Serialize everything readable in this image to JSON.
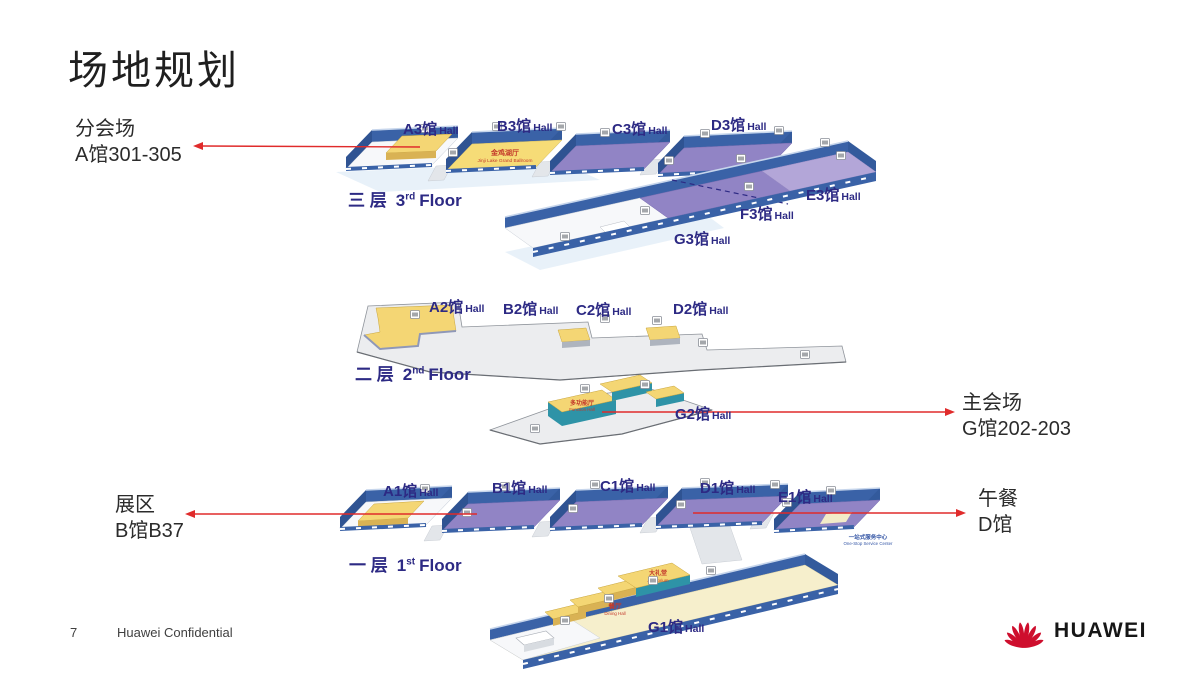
{
  "slide": {
    "title": "场地规划",
    "page_number": "7",
    "footer_text": "Huawei Confidential",
    "logo_wordmark": "HUAWEI"
  },
  "labels": {
    "hall_suffix": "Hall"
  },
  "floors": {
    "third": {
      "floor_cn": "三 层",
      "ordinal": "3",
      "ordinal_suffix": "rd",
      "floor_word": "Floor",
      "halls": {
        "a3": "A3馆",
        "b3": "B3馆",
        "c3": "C3馆",
        "d3": "D3馆",
        "e3": "E3馆",
        "f3": "F3馆",
        "g3": "G3馆"
      }
    },
    "second": {
      "floor_cn": "二 层",
      "ordinal": "2",
      "ordinal_suffix": "nd",
      "floor_word": "Floor",
      "halls": {
        "a2": "A2馆",
        "b2": "B2馆",
        "c2": "C2馆",
        "d2": "D2馆",
        "g2": "G2馆"
      }
    },
    "first": {
      "floor_cn": "一 层",
      "ordinal": "1",
      "ordinal_suffix": "st",
      "floor_word": "Floor",
      "halls": {
        "a1": "A1馆",
        "b1": "B1馆",
        "c1": "C1馆",
        "d1": "D1馆",
        "e1": "E1馆",
        "g1": "G1馆"
      }
    }
  },
  "callouts": {
    "breakout": {
      "line1": "分会场",
      "line2": "A馆301-305"
    },
    "main_venue": {
      "line1": "主会场",
      "line2": "G馆202-203"
    },
    "exhibition": {
      "line1": "展区",
      "line2": "B馆B37"
    },
    "lunch": {
      "line1": "午餐",
      "line2": "D馆"
    }
  },
  "annotations": {
    "ballroom": {
      "cn": "金鸡湖厅",
      "en": "Jinji Lake Grand Ballroom"
    },
    "function_hall": {
      "cn": "多功能厅",
      "en": "Function Hall"
    },
    "auditorium": {
      "cn": "大礼堂",
      "en": "Auditorium"
    },
    "dining": {
      "cn": "餐厅",
      "en": "Dining Hall"
    },
    "service_center": {
      "cn": "一站式服务中心",
      "en": "One-Stop Service Center"
    }
  },
  "colors": {
    "arrow_red": "#E02B2B",
    "label_navy": "#2D2A84",
    "huawei_red": "#CE0E2D",
    "hall_purple": "#9184C5",
    "hall_yellow": "#F4D674",
    "wall_blue": "#3A62A7"
  }
}
